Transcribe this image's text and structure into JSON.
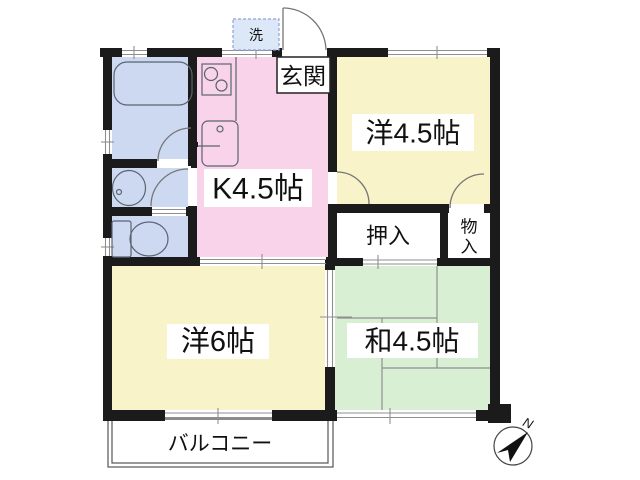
{
  "floor_plan": {
    "room_labels": {
      "kitchen": "K4.5帖",
      "western_room_small": "洋4.5帖",
      "western_room_large": "洋6帖",
      "japanese_room": "和4.5帖"
    },
    "area_labels": {
      "entrance": "玄関",
      "washer": "洗",
      "closet": "押入",
      "storage": "物入",
      "storage_chars": [
        "物",
        "入"
      ],
      "balcony": "バルコニー"
    },
    "compass": {
      "north": "N"
    },
    "colors": {
      "wall": "#1b1b1b",
      "kitchen_pink": "#f8d3ea",
      "western_yellow": "#f9f3c9",
      "japanese_green": "#d9efd4",
      "sanitary_blue": "#cdd9f1",
      "washer_blue": "#dce8f7",
      "washer_border": "#8fa3d8",
      "closet_white": "#ffffff",
      "label_plate": "#ffffff",
      "thin_line": "#8f8f8f",
      "fixture_line": "#5a6470",
      "door_arc": "#767676"
    }
  }
}
